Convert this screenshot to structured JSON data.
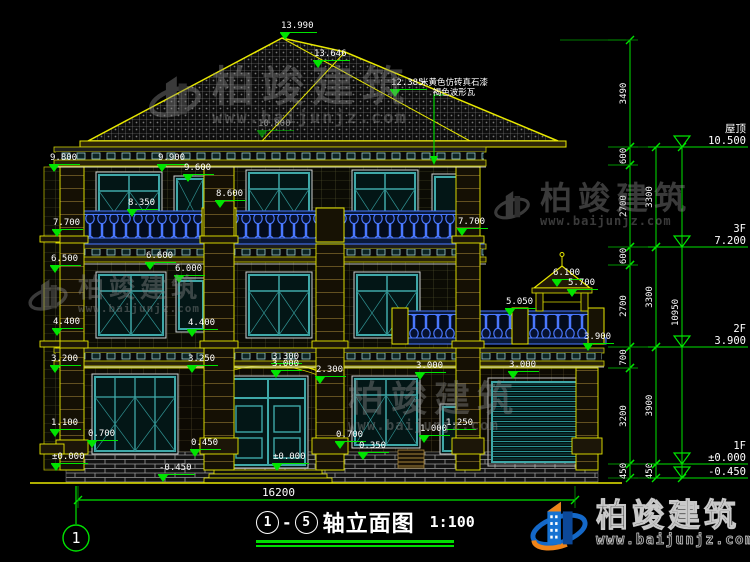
{
  "title": {
    "axis_from": "1",
    "axis_to": "5",
    "dash": "-",
    "label": "轴立面图",
    "scale": "1:100"
  },
  "axis_bubble": "1",
  "ground_dim": {
    "label": "16200",
    "x1": 78,
    "x2": 575,
    "y": 500
  },
  "material_note": {
    "line1": "米黄色仿砖真石漆",
    "line2": "褐色波形瓦"
  },
  "watermark": {
    "name": "柏竣建筑",
    "url": "www.baijunjz.com"
  },
  "colors": {
    "dim_green": "#00e400",
    "line_yellow": "#e8e800",
    "window_teal": "#3fa8a8",
    "baluster_blue": "#4a78ff",
    "text_white": "#ffffff"
  },
  "levels": [
    {
      "name": "屋顶",
      "value": "10.500",
      "y": 147
    },
    {
      "name": "3F",
      "value": "7.200",
      "y": 247
    },
    {
      "name": "2F",
      "value": "3.900",
      "y": 347
    },
    {
      "name": "1F",
      "value": "±0.000",
      "y": 464
    },
    {
      "name": "",
      "value": "-0.450",
      "y": 478
    }
  ],
  "chains": [
    {
      "x": 630,
      "segments": [
        {
          "a": 40,
          "b": 147,
          "label": "3490"
        },
        {
          "a": 147,
          "b": 165,
          "label": "600"
        },
        {
          "a": 165,
          "b": 247,
          "label": "2700"
        },
        {
          "a": 247,
          "b": 265,
          "label": "600"
        },
        {
          "a": 265,
          "b": 347,
          "label": "2700"
        },
        {
          "a": 347,
          "b": 368,
          "label": "700"
        },
        {
          "a": 368,
          "b": 464,
          "label": "3200"
        },
        {
          "a": 464,
          "b": 478,
          "label": "450"
        }
      ]
    },
    {
      "x": 656,
      "segments": [
        {
          "a": 147,
          "b": 247,
          "label": "3300"
        },
        {
          "a": 247,
          "b": 347,
          "label": "3300"
        },
        {
          "a": 347,
          "b": 464,
          "label": "3900"
        },
        {
          "a": 464,
          "b": 478,
          "label": "450"
        }
      ]
    },
    {
      "x": 682,
      "segments": [
        {
          "a": 147,
          "b": 478,
          "label": "10950"
        }
      ]
    }
  ],
  "markers": [
    {
      "label": "13.990",
      "x": 285,
      "y": 40
    },
    {
      "label": "13.646",
      "x": 318,
      "y": 68
    },
    {
      "label": "12.385",
      "x": 395,
      "y": 97
    },
    {
      "label": "10.800",
      "x": 262,
      "y": 138,
      "faded": true
    },
    {
      "label": "9.800",
      "x": 54,
      "y": 172
    },
    {
      "label": "9.900",
      "x": 162,
      "y": 172
    },
    {
      "label": "9.600",
      "x": 188,
      "y": 182
    },
    {
      "label": "8.600",
      "x": 220,
      "y": 208
    },
    {
      "label": "8.350",
      "x": 132,
      "y": 217
    },
    {
      "label": "7.700",
      "x": 57,
      "y": 237
    },
    {
      "label": "7.700",
      "x": 462,
      "y": 236
    },
    {
      "label": "6.600",
      "x": 150,
      "y": 270
    },
    {
      "label": "6.500",
      "x": 55,
      "y": 273
    },
    {
      "label": "6.100",
      "x": 557,
      "y": 287
    },
    {
      "label": "6.000",
      "x": 179,
      "y": 283
    },
    {
      "label": "5.700",
      "x": 572,
      "y": 297
    },
    {
      "label": "5.050",
      "x": 510,
      "y": 316
    },
    {
      "label": "4.400",
      "x": 57,
      "y": 336
    },
    {
      "label": "4.400",
      "x": 192,
      "y": 337
    },
    {
      "label": "3.900",
      "x": 588,
      "y": 351
    },
    {
      "label": "3.300",
      "x": 276,
      "y": 364,
      "tri": false
    },
    {
      "label": "3.250",
      "x": 192,
      "y": 373
    },
    {
      "label": "3.200",
      "x": 55,
      "y": 373
    },
    {
      "label": "3.000",
      "x": 276,
      "y": 378
    },
    {
      "label": "2.300",
      "x": 320,
      "y": 384
    },
    {
      "label": "3.000",
      "x": 420,
      "y": 380
    },
    {
      "label": "3.000",
      "x": 513,
      "y": 379
    },
    {
      "label": "1.250",
      "x": 450,
      "y": 430,
      "tri": false
    },
    {
      "label": "1.100",
      "x": 55,
      "y": 437
    },
    {
      "label": "1.000",
      "x": 424,
      "y": 443
    },
    {
      "label": "0.700",
      "x": 92,
      "y": 448
    },
    {
      "label": "0.700",
      "x": 340,
      "y": 449
    },
    {
      "label": "0.450",
      "x": 195,
      "y": 457
    },
    {
      "label": "0.350",
      "x": 363,
      "y": 460
    },
    {
      "label": "±0.000",
      "x": 56,
      "y": 471
    },
    {
      "label": "±0.000",
      "x": 277,
      "y": 471
    },
    {
      "label": "-0.450",
      "x": 163,
      "y": 482
    }
  ]
}
